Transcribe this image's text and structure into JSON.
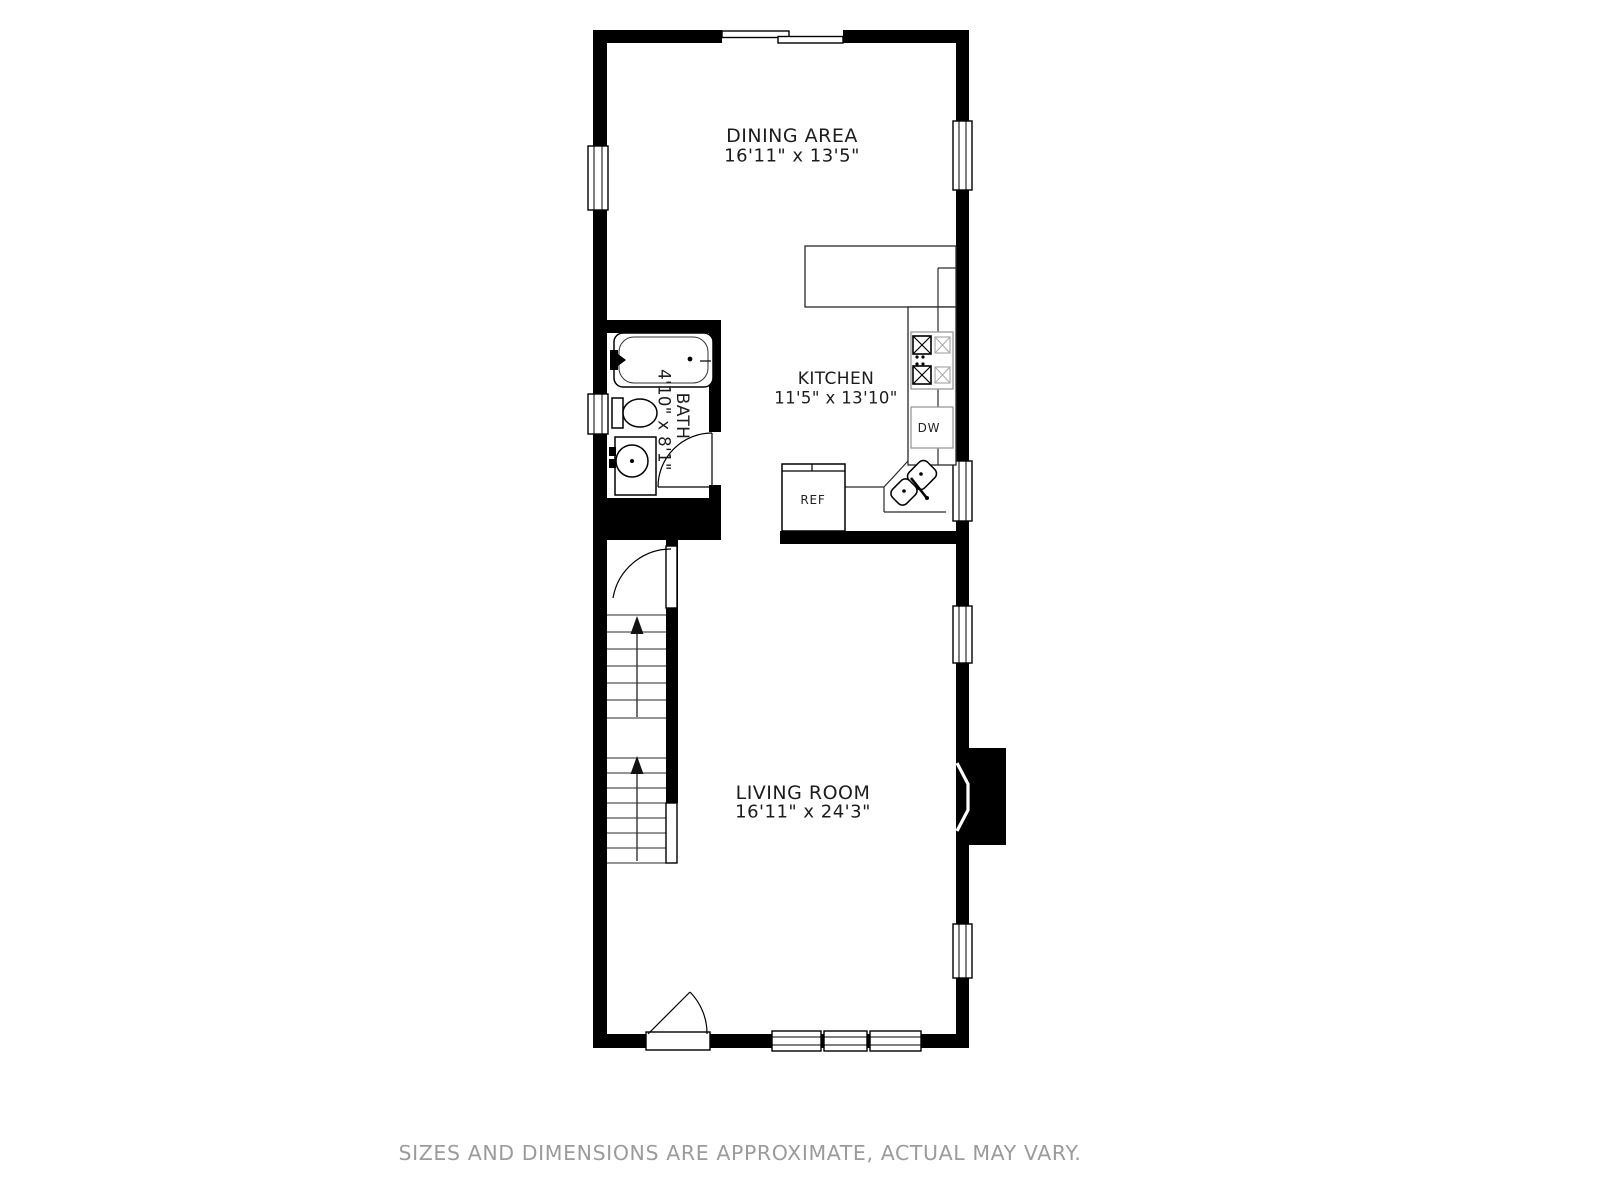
{
  "rooms": [
    {
      "id": "dining-area",
      "name": "DINING AREA",
      "dimensions": "16'11\" x 13'5\""
    },
    {
      "id": "kitchen",
      "name": "KITCHEN",
      "dimensions": "11'5\" x 13'10\""
    },
    {
      "id": "bath",
      "name": "BATH",
      "dimensions": "4'10\" x 8'1\""
    },
    {
      "id": "living-room",
      "name": "LIVING ROOM",
      "dimensions": "16'11\" x 24'3\""
    }
  ],
  "appliances": {
    "refrigerator": "REF",
    "dishwasher": "DW"
  },
  "footer": {
    "disclaimer": "SIZES AND DIMENSIONS ARE APPROXIMATE, ACTUAL MAY VARY."
  },
  "colors": {
    "wall": "#000000",
    "background": "#ffffff",
    "label_text": "#1c1c1c",
    "caption_text": "#9b9b9b",
    "appliance_outline": "#999999",
    "tread_line": "#555555"
  }
}
